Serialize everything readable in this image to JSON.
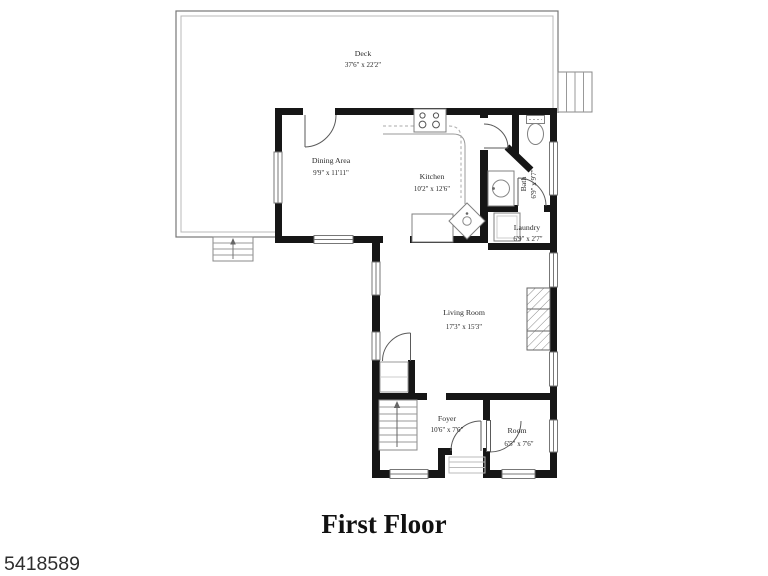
{
  "title": "First Floor",
  "listing_id": "5418589",
  "rooms": {
    "deck": {
      "name": "Deck",
      "dims": "37'6\" x 22'2\""
    },
    "dining": {
      "name": "Dining Area",
      "dims": "9'9\" x 11'11\""
    },
    "kitchen": {
      "name": "Kitchen",
      "dims": "10'2\" x 12'6\""
    },
    "bath": {
      "name": "Bath",
      "dims": "6'9\" x 9'7\""
    },
    "laundry": {
      "name": "Laundry",
      "dims": "6'9\" x 2'7\""
    },
    "living": {
      "name": "Living Room",
      "dims": "17'3\" x 15'3\""
    },
    "foyer": {
      "name": "Foyer",
      "dims": "10'6\" x 7'6\""
    },
    "room": {
      "name": "Room",
      "dims": "6'5\" x 7'6\""
    }
  },
  "colors": {
    "wall": "#161616",
    "thin_line": "#888888",
    "label_text": "#2a2a2a",
    "background": "#ffffff"
  }
}
